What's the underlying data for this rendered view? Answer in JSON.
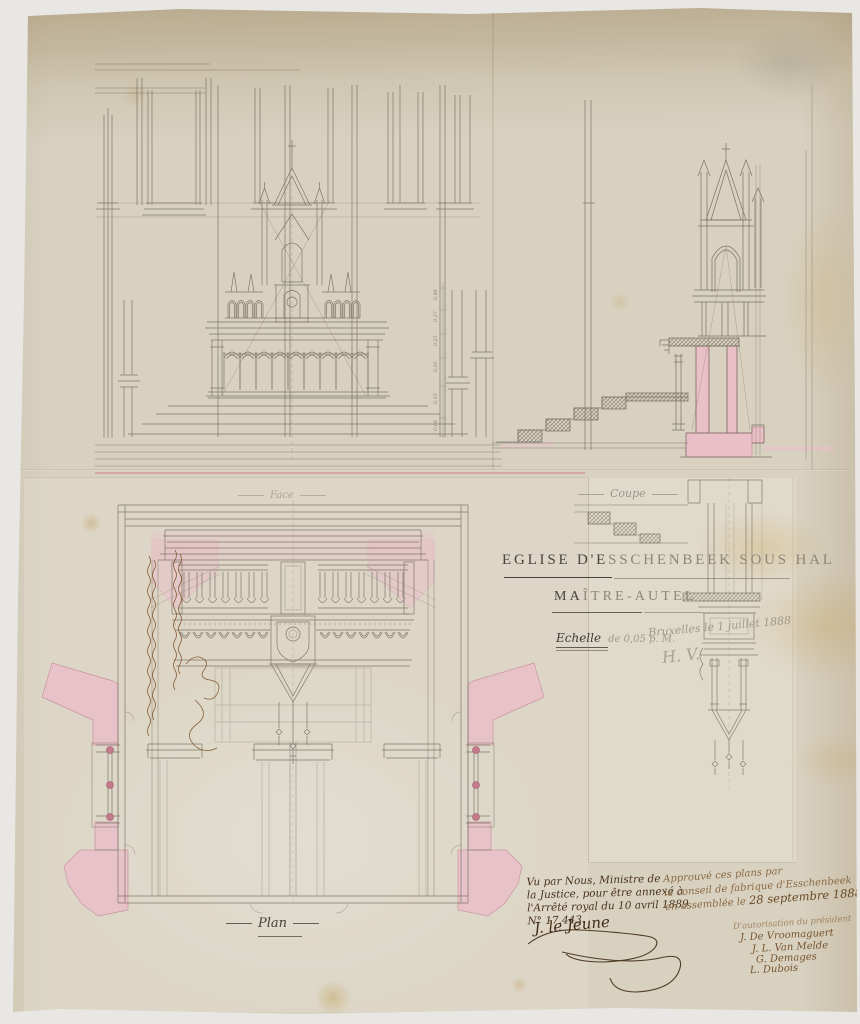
{
  "sheet": {
    "title_dark": "EGLISE D'E",
    "title_faint": "SSCHENBEEK SOUS HAL",
    "subtitle_dark": "MA",
    "subtitle_faint": "ÎTRE-AUTEL",
    "scale_label": "Echelle",
    "scale_value": "de 0,05 p. M.",
    "place_date": "Bruxelles le 1 juillet 1888",
    "architect_signature": "H. V."
  },
  "view_labels": {
    "face": "Face",
    "coupe": "Coupe",
    "plan": "Plan"
  },
  "dimension_marks": [
    "0,48",
    "0,37",
    "0,25",
    "0,95",
    "0,13",
    "0,08"
  ],
  "minister_note": {
    "line1": "Vu par Nous, Ministre de",
    "line2": "la Justice, pour être annexé à",
    "line3": "l'Arrêté royal du 10 avril 1889,",
    "line4": "N° 17.443.",
    "signature": "J. le Jeune"
  },
  "fabrique_note": {
    "line1": "Approuvé ces plans par",
    "line2": "le conseil de fabrique d'Esschenbeek",
    "line3_prefix": "en assemblée le ",
    "line3_date": "28 septembre 1888",
    "line4": "D'autorisation du président",
    "signatures": [
      "J. De Vroomaguert",
      "J. L. Van Melde",
      "G. Demages",
      "L. Dubois"
    ]
  },
  "colors": {
    "paper": "#d8d1c0",
    "wash_pink": "#e9bfc8",
    "ink": "#46413a",
    "ink_brown": "#4f3418",
    "pencil": "#979184"
  }
}
